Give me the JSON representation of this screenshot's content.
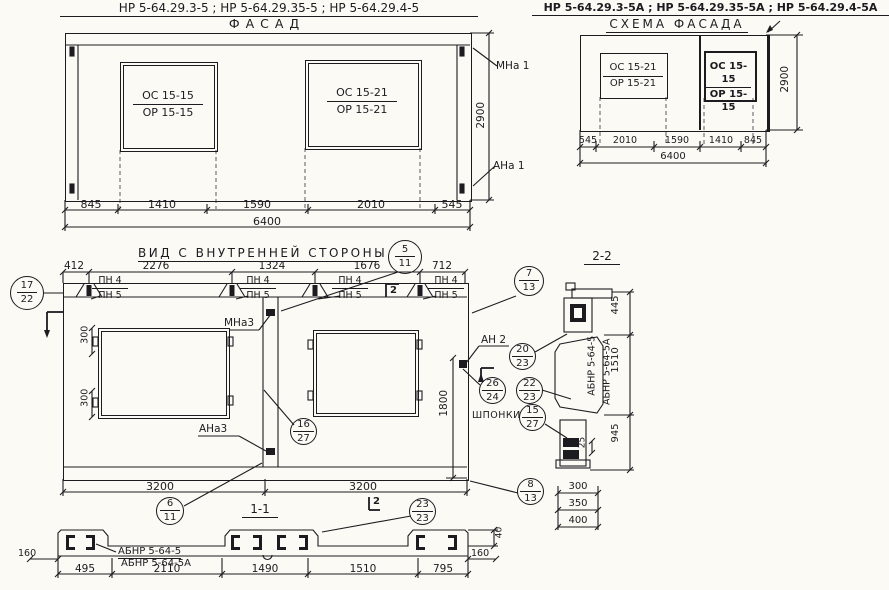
{
  "header": {
    "left_codes": "НР 5-64.29.3-5 ;  НР 5-64.29.35-5 ;  НР 5-64.29.4-5",
    "left_title": "ФАСАД",
    "right_codes": "НР 5-64.29.3-5А ; НР 5-64.29.35-5А ; НР 5-64.29.4-5А",
    "right_title": "СХЕМА ФАСАДА"
  },
  "facade": {
    "win_left_top": "ОС 15-15",
    "win_left_bot": "ОР 15-15",
    "win_right_top": "ОС 15-21",
    "win_right_bot": "ОР 15-21",
    "mark_upper": "МНа 1",
    "mark_lower": "АНа 1",
    "dim_height": "2900",
    "dims": {
      "d1": "845",
      "d2": "1410",
      "d3": "1590",
      "d4": "2010",
      "d5": "545"
    },
    "dim_total": "6400"
  },
  "schema": {
    "win_left_top": "ОС 15-21",
    "win_left_bot": "ОР 15-21",
    "win_right_top": "ОС 15-15",
    "win_right_bot": "ОР 15-15",
    "dim_height": "2900",
    "dims": {
      "d1": "545",
      "d2": "2010",
      "d3": "1590",
      "d4": "1410",
      "d5": "845"
    },
    "dim_total": "6400"
  },
  "inner": {
    "title": "ВИД С ВНУТРЕННЕЙ СТОРОНЫ",
    "top_dims": {
      "d1": "412",
      "d2": "2276",
      "d3": "1324",
      "d4": "1676",
      "d5": "712"
    },
    "pn_top": "ПН 4",
    "pn_bot": "ПН 5",
    "mark_mna3": "МНа3",
    "mark_ana3": "АНа3",
    "mark_an2": "АН 2",
    "label_shponki": "ШПОНКИ",
    "dim_300_top": "300",
    "dim_300_bot": "300",
    "dim_1800": "1800",
    "dim_3200_left": "3200",
    "dim_3200_right": "3200",
    "cut_top": "2",
    "cut_bottom": "2",
    "balloons": {
      "b5": {
        "t": "5",
        "b": "11"
      },
      "b17": {
        "t": "17",
        "b": "22"
      },
      "b7": {
        "t": "7",
        "b": "13"
      },
      "b20": {
        "t": "20",
        "b": "23"
      },
      "b26": {
        "t": "26",
        "b": "24"
      },
      "b22": {
        "t": "22",
        "b": "23"
      },
      "b15": {
        "t": "15",
        "b": "27"
      },
      "b16": {
        "t": "16",
        "b": "27"
      },
      "b8": {
        "t": "8",
        "b": "13"
      },
      "b6": {
        "t": "6",
        "b": "11"
      },
      "b23": {
        "t": "23",
        "b": "23"
      }
    }
  },
  "sec11": {
    "title": "1-1",
    "label_top": "АБНР 5-64-5",
    "label_bot": "АБНР 5-64-5А",
    "dim_160_left": "160",
    "dim_160_right": "160",
    "dim_40": "40",
    "dims": {
      "d1": "495",
      "d2": "2110",
      "d3": "1490",
      "d4": "1510",
      "d5": "795"
    }
  },
  "sec22": {
    "title": "2-2",
    "label_a": "АБНР 5-64-5",
    "label_b": "АБНР 5-64-5А",
    "dim_445": "445",
    "dim_1510": "1510",
    "dim_945": "945",
    "dim_25": "25",
    "dim_300": "300",
    "dim_350": "350",
    "dim_400": "400"
  }
}
